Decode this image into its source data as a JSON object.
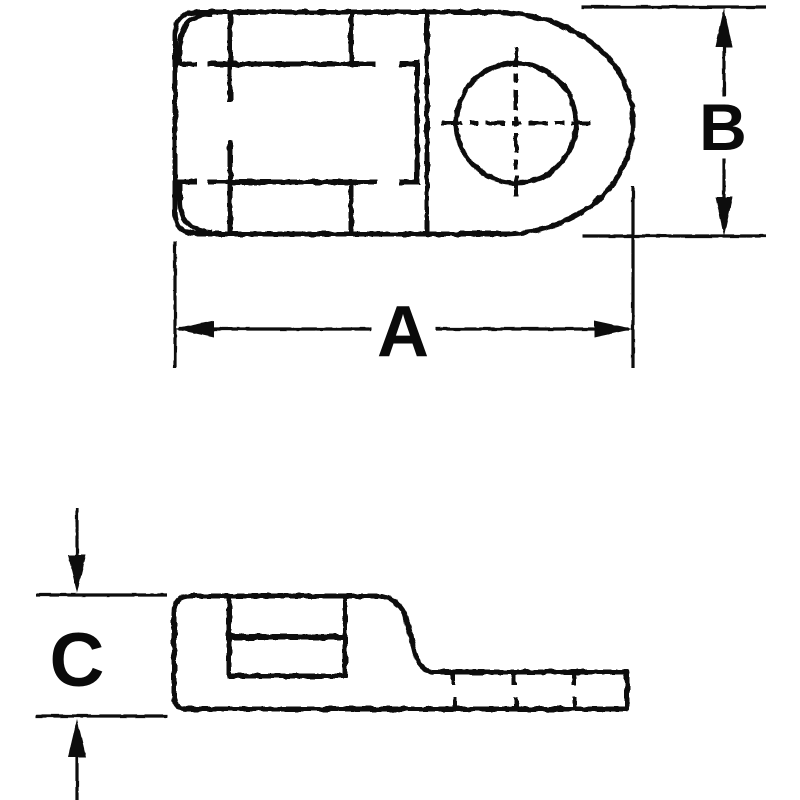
{
  "drawing": {
    "background_color": "#ffffff",
    "line_color": "#0a0a0a",
    "dimension_labels": {
      "a": "A",
      "b": "B",
      "c": "C"
    }
  }
}
